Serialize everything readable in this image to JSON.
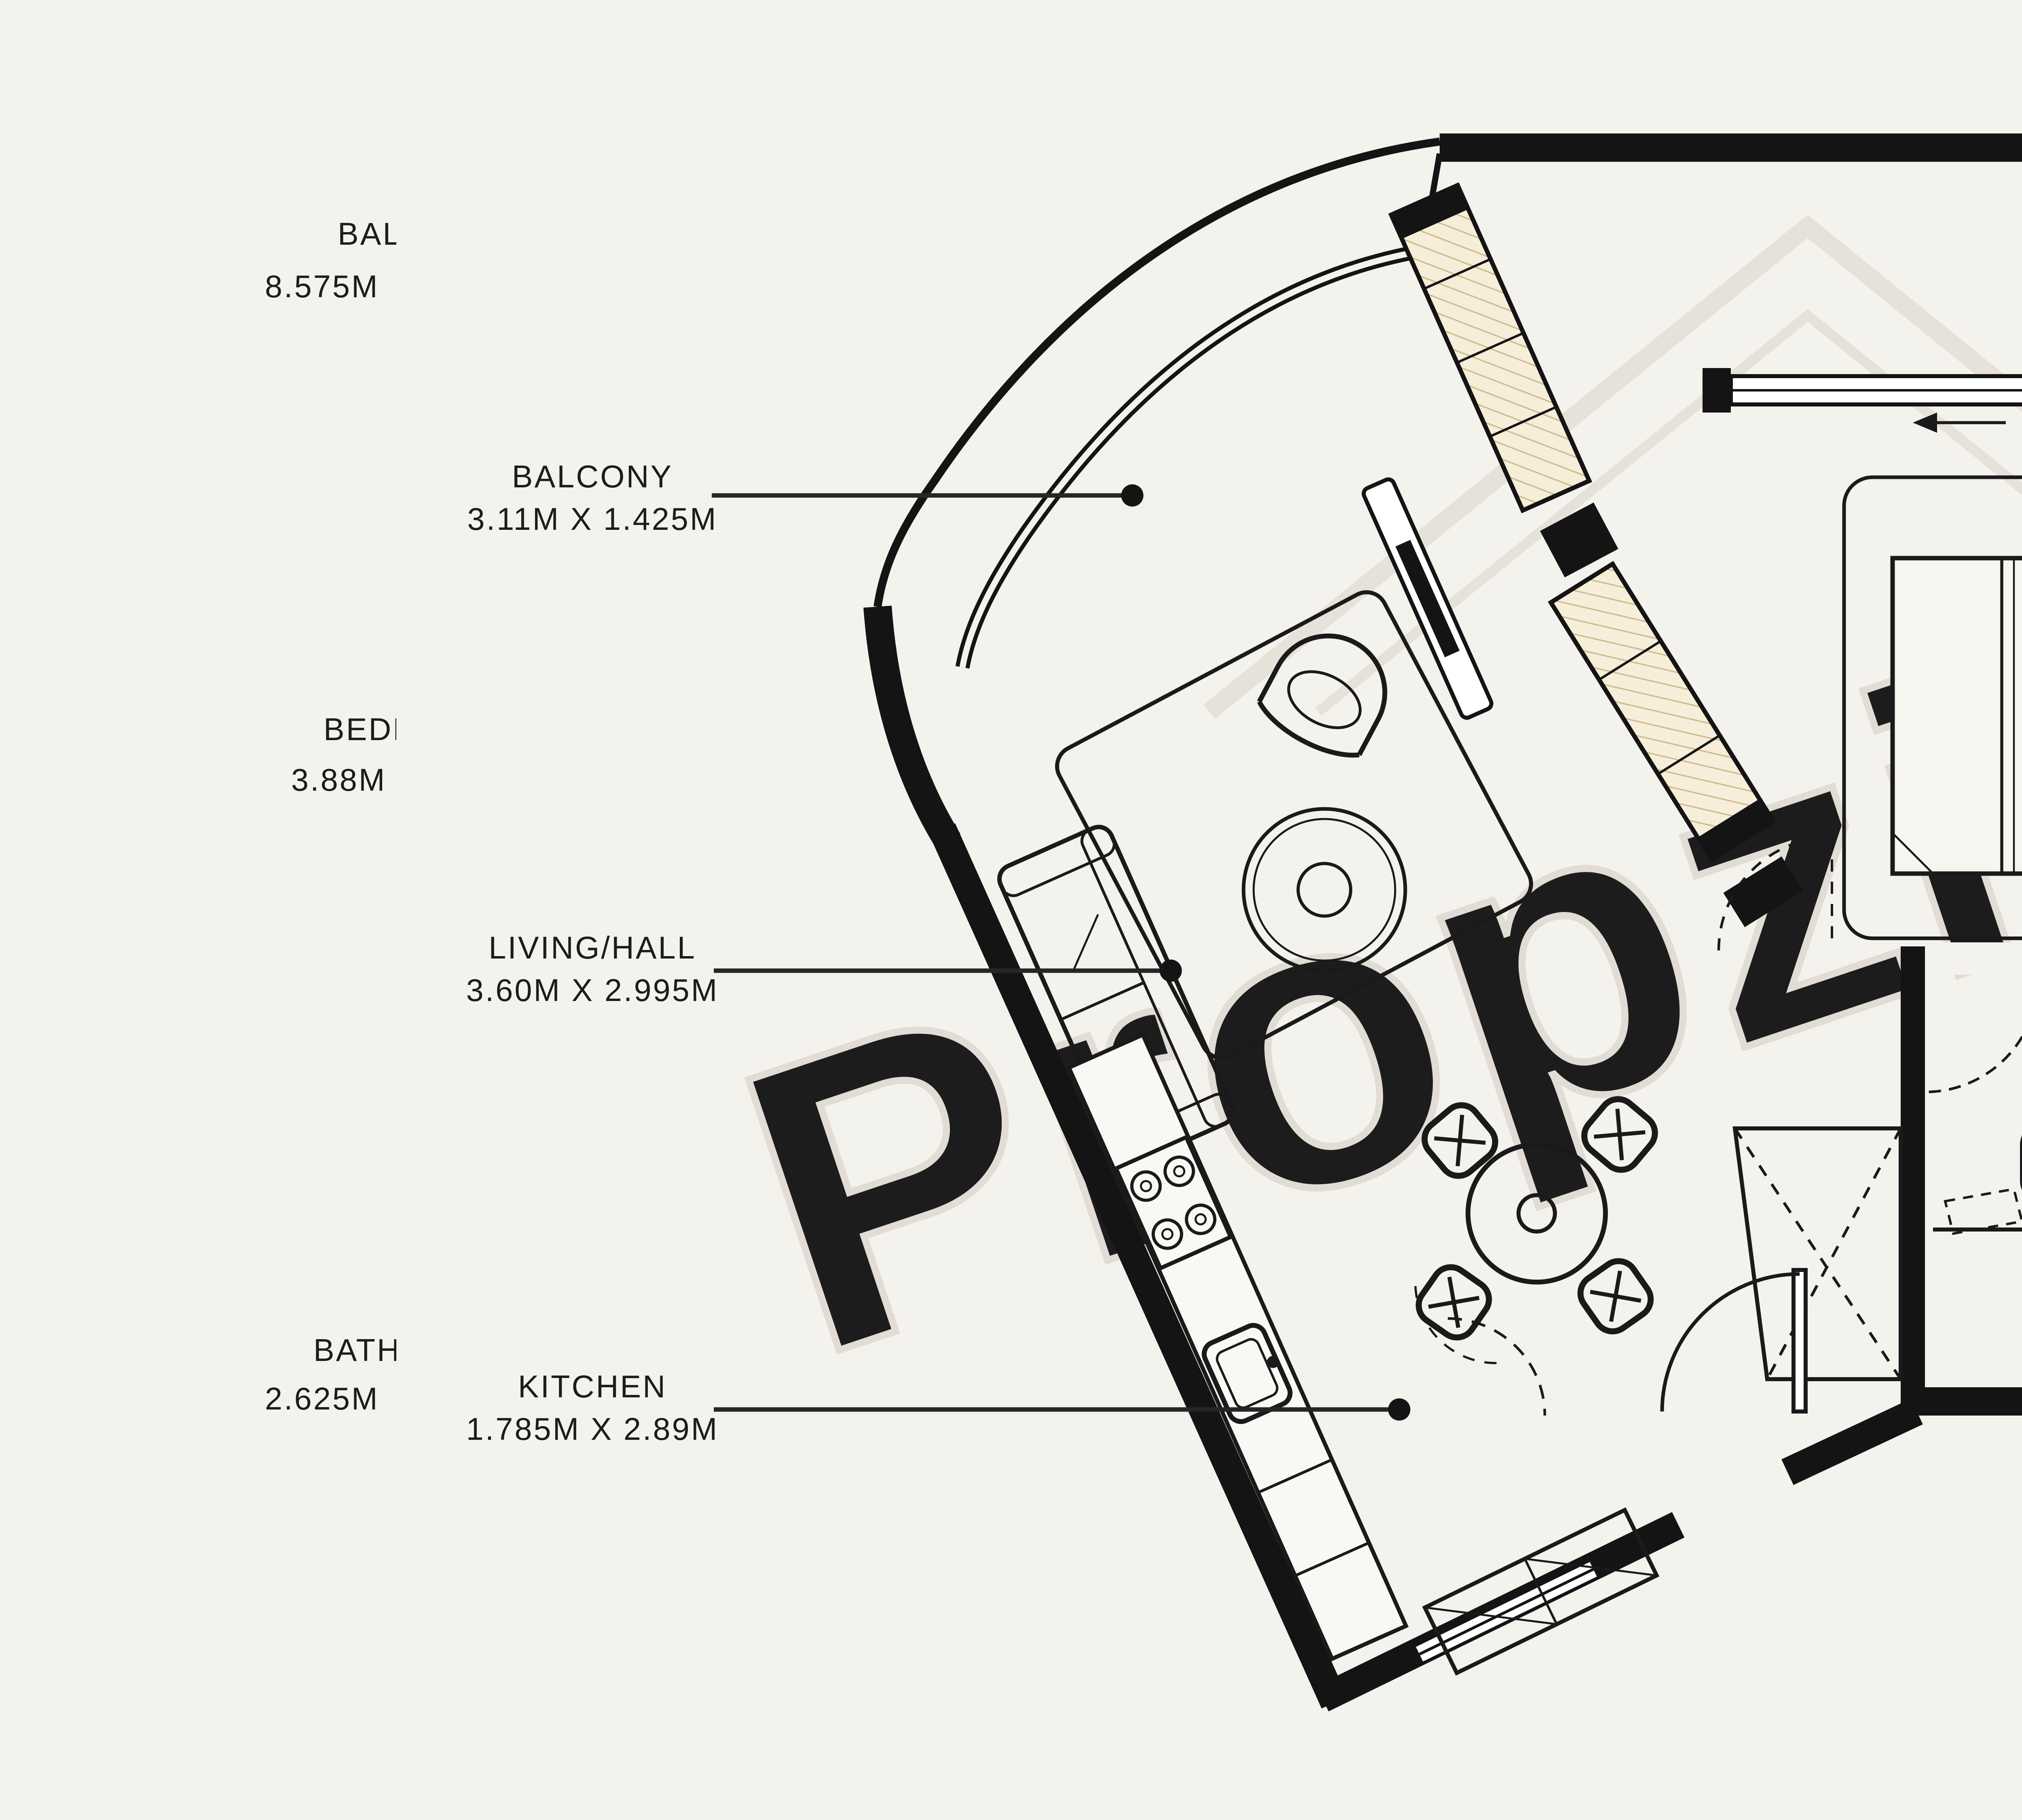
{
  "background_color": "#f4f2ed",
  "watermark": {
    "text": "Propzilla",
    "registered_symbol": "R",
    "color": "#e1ddd5"
  },
  "rooms": [
    {
      "id": "balcony_left",
      "name": "BALCONY",
      "dims": "3.11M X 1.425M"
    },
    {
      "id": "balcony_right",
      "name": "BALCONY",
      "dims": "2.79M X 1.43M"
    },
    {
      "id": "bedroom",
      "name": "BEDROOM",
      "dims": "4.82M X 3.195M"
    },
    {
      "id": "living_hall",
      "name": "LIVING/HALL",
      "dims": "3.60M X 2.995M"
    },
    {
      "id": "bathroom",
      "name": "BATHROOM",
      "dims": "1.65M X 2.625M"
    },
    {
      "id": "kitchen",
      "name": "KITCHEN",
      "dims": "1.785M X 2.89M"
    }
  ],
  "edge_fragments": {
    "left": [
      {
        "line1": "BAL",
        "line2": "8.575M"
      },
      {
        "line1": "BEDR",
        "line2": "3.88M"
      },
      {
        "line1": "BATH",
        "line2": "2.625M"
      }
    ],
    "right": [
      {
        "line1": "/HALL",
        "line2": "X 3.15M"
      },
      {
        "line1": "HEN",
        "line2": "X 2.13M"
      },
      {
        "line1": "R ROOM",
        "line2": "X 1.50M"
      }
    ]
  }
}
